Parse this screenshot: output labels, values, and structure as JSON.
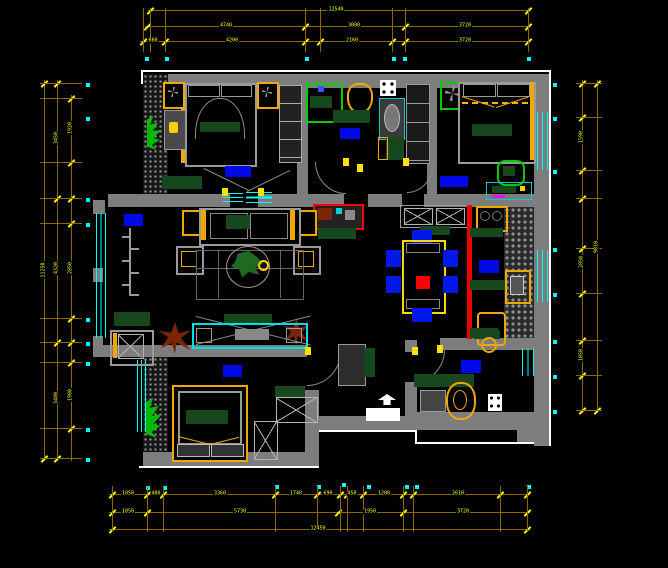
{
  "drawing": {
    "title": "apartment-floor-plan",
    "background": "#000000",
    "palette": {
      "wall_gray": "#7d7d7d",
      "outer_outline": "#ffffff",
      "window_cyan": "#00ffff",
      "dimension_line": "#8a6a00",
      "dimension_text": "#ffff00",
      "grip_cyan": "#00ffff",
      "door_pivot_yellow": "#ffe000",
      "furniture_dark_green": "#17471c",
      "fixture_orange": "#f0a800",
      "room_label_blue": "#0008e8",
      "accent_red": "#ff0000",
      "plant_brown": "#7a2508",
      "accent_bright_green": "#00c800"
    },
    "room_labels": [
      {
        "room": "master-bedroom",
        "x": 225,
        "y": 166,
        "w": 26,
        "h": 11
      },
      {
        "room": "bathroom-1",
        "x": 340,
        "y": 128,
        "w": 20,
        "h": 11
      },
      {
        "room": "bedroom-2",
        "x": 440,
        "y": 176,
        "w": 28,
        "h": 11
      },
      {
        "room": "living-room",
        "x": 124,
        "y": 214,
        "w": 19,
        "h": 12
      },
      {
        "room": "kitchen",
        "x": 479,
        "y": 260,
        "w": 20,
        "h": 13
      },
      {
        "room": "bathroom-2",
        "x": 461,
        "y": 360,
        "w": 20,
        "h": 13
      },
      {
        "room": "bedroom-3",
        "x": 223,
        "y": 365,
        "w": 19,
        "h": 12
      }
    ],
    "door_pivots": [
      [
        343,
        158
      ],
      [
        357,
        164
      ],
      [
        403,
        158
      ],
      [
        305,
        347
      ],
      [
        412,
        347
      ],
      [
        222,
        188
      ],
      [
        258,
        188
      ],
      [
        437,
        345
      ]
    ],
    "grips": [
      [
        145,
        57
      ],
      [
        165,
        57
      ],
      [
        305,
        57
      ],
      [
        392,
        57
      ],
      [
        403,
        57
      ],
      [
        527,
        57
      ],
      [
        86,
        83
      ],
      [
        86,
        117
      ],
      [
        86,
        198
      ],
      [
        86,
        223
      ],
      [
        86,
        318
      ],
      [
        86,
        342
      ],
      [
        86,
        362
      ],
      [
        86,
        428
      ],
      [
        86,
        458
      ],
      [
        553,
        83
      ],
      [
        553,
        117
      ],
      [
        553,
        170
      ],
      [
        553,
        248
      ],
      [
        553,
        293
      ],
      [
        553,
        340
      ],
      [
        553,
        375
      ],
      [
        553,
        410
      ],
      [
        146,
        486
      ],
      [
        163,
        486
      ],
      [
        275,
        485
      ],
      [
        317,
        485
      ],
      [
        342,
        483
      ],
      [
        367,
        485
      ],
      [
        405,
        485
      ],
      [
        415,
        485
      ],
      [
        527,
        485
      ]
    ],
    "dimensions": {
      "top_rows": [
        {
          "y": 10,
          "x1": 148,
          "x2": 530,
          "ticks": [
            150,
            528
          ],
          "labels": [
            {
              "t": "12540",
              "x": 336
            }
          ]
        },
        {
          "y": 26,
          "x1": 145,
          "x2": 530,
          "ticks": [
            147,
            305,
            405,
            528
          ],
          "labels": [
            {
              "t": "4740",
              "x": 226
            },
            {
              "t": "3000",
              "x": 354
            },
            {
              "t": "3720",
              "x": 465
            }
          ]
        },
        {
          "y": 41,
          "x1": 140,
          "x2": 530,
          "ticks": [
            143,
            165,
            305,
            320,
            392,
            405,
            528
          ],
          "labels": [
            {
              "t": "660",
              "x": 153
            },
            {
              "t": "4200",
              "x": 232
            },
            {
              "t": "2160",
              "x": 352
            },
            {
              "t": "3720",
              "x": 465
            }
          ]
        }
      ],
      "top_witness": [
        143,
        150,
        165,
        305,
        320,
        392,
        405,
        528
      ],
      "left_cols": [
        {
          "x": 44,
          "y1": 80,
          "y2": 461,
          "ticks": [
            83,
            458
          ],
          "labels": [
            {
              "t": "11250",
              "y": 270
            }
          ]
        },
        {
          "x": 57,
          "y1": 80,
          "y2": 461,
          "ticks": [
            83,
            198,
            342,
            458
          ],
          "labels": [
            {
              "t": "3450",
              "y": 138
            },
            {
              "t": "4320",
              "y": 268
            },
            {
              "t": "3480",
              "y": 398
            }
          ]
        },
        {
          "x": 71,
          "y1": 95,
          "y2": 461,
          "ticks": [
            98,
            162,
            198,
            223,
            318,
            342,
            362,
            428
          ],
          "labels": [
            {
              "t": "1920",
              "y": 128
            },
            {
              "t": "2850",
              "y": 268
            },
            {
              "t": "1980",
              "y": 395
            }
          ]
        }
      ],
      "left_witness": [
        83,
        98,
        162,
        198,
        223,
        318,
        342,
        362,
        428,
        458
      ],
      "right_cols": [
        {
          "x": 582,
          "y1": 80,
          "y2": 413,
          "ticks": [
            83,
            117,
            170,
            198,
            248,
            293,
            340,
            375,
            410
          ],
          "labels": [
            {
              "t": "1590",
              "y": 137
            },
            {
              "t": "2850",
              "y": 262
            },
            {
              "t": "1050",
              "y": 355
            }
          ]
        },
        {
          "x": 597,
          "y1": 80,
          "y2": 413,
          "ticks": [
            83,
            410
          ],
          "labels": [
            {
              "t": "9810",
              "y": 247
            }
          ]
        }
      ],
      "right_witness": [
        83,
        117,
        170,
        198,
        248,
        293,
        340,
        375,
        410
      ],
      "bottom_rows": [
        {
          "y": 494,
          "x1": 109,
          "x2": 530,
          "ticks": [
            112,
            147,
            163,
            275,
            317,
            340,
            347,
            363,
            403,
            413,
            500,
            527
          ],
          "labels": [
            {
              "t": "1050",
              "x": 128
            },
            {
              "t": "480",
              "x": 156
            },
            {
              "t": "3360",
              "x": 220
            },
            {
              "t": "1740",
              "x": 296
            },
            {
              "t": "690",
              "x": 328
            },
            {
              "t": "450",
              "x": 352
            },
            {
              "t": "1200",
              "x": 384
            },
            {
              "t": "2610",
              "x": 458
            }
          ]
        },
        {
          "y": 512,
          "x1": 109,
          "x2": 530,
          "ticks": [
            112,
            147,
            338,
            403,
            527
          ],
          "labels": [
            {
              "t": "1050",
              "x": 128
            },
            {
              "t": "5730",
              "x": 240
            },
            {
              "t": "1950",
              "x": 370
            },
            {
              "t": "3720",
              "x": 463
            }
          ]
        },
        {
          "y": 529,
          "x1": 109,
          "x2": 530,
          "ticks": [
            112,
            527
          ],
          "labels": [
            {
              "t": "12450",
              "x": 318
            }
          ]
        }
      ],
      "bottom_witness": [
        112,
        147,
        163,
        275,
        317,
        340,
        347,
        363,
        403,
        413,
        500,
        527
      ]
    }
  }
}
